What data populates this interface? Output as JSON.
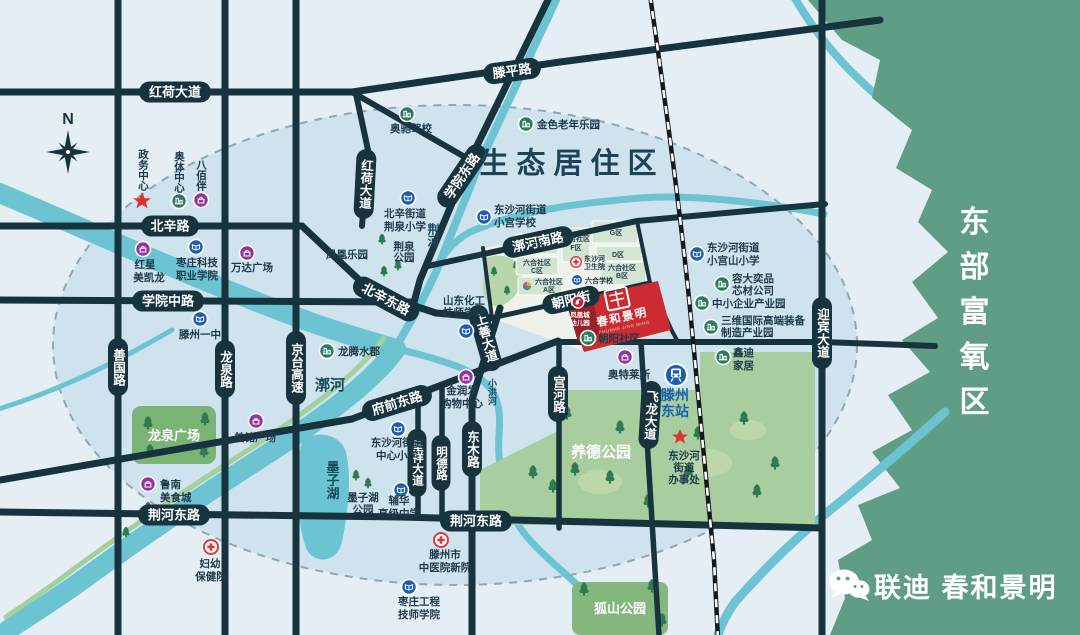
{
  "zones": {
    "eco": "生态居住区",
    "east": "东部富氧区"
  },
  "compass": {
    "north": "N"
  },
  "roads": {
    "honghe": "红荷大道",
    "tengping": "滕平路",
    "beixin": "北辛路",
    "xueyuan_mid": "学院中路",
    "xueyuan_east": "学院东路",
    "beixin_east": "北辛东路",
    "shanguo": "善国路",
    "longquan": "龙泉路",
    "jingtai": "京台高速",
    "guohe_south": "漷河南路",
    "chaoyang": "朝阳街",
    "shangshan": "上善大道",
    "fuqian_east": "府前东路",
    "gonghe": "宫河路",
    "dongmu": "东木路",
    "chengxiang": "呈祥大道",
    "mingde": "明德路",
    "jinghe_east": "荆河东路",
    "feilong": "飞龙大道",
    "yingbin": "迎宾大道"
  },
  "waters": {
    "jinghe": "荆河",
    "guohe": "漷河",
    "xiaohong": "小洪河",
    "mozihu": "墨子湖"
  },
  "parks": {
    "longquan_sq": "龙泉广场",
    "jingquan_1": "荆泉",
    "jingquan_2": "公园",
    "mozihu_1": "墨子湖",
    "mozihu_2": "公园",
    "yangde": "养德公园",
    "hushan": "狐山公园"
  },
  "blocks": {
    "prefix": "六合社区",
    "a": "A区",
    "b": "B区",
    "c": "C区",
    "d": "D区",
    "e": "E区",
    "f": "F区",
    "g": "G区"
  },
  "project": {
    "name": "春和景明",
    "pinyin": "CHUNHE JING MING"
  },
  "footer": {
    "brand": "联迪 春和景明"
  },
  "pois": {
    "zwzx": {
      "l1": "政务中心"
    },
    "atzx": {
      "l1": "奥体中心"
    },
    "bbb": {
      "l1": "八佰伴"
    },
    "hxmkl": {
      "l1": "红星",
      "l2": "美凯龙"
    },
    "zzkj": {
      "l1": "枣庄科技",
      "l2": "职业学院"
    },
    "wdgc": {
      "l1": "万达广场"
    },
    "tzyz": {
      "l1": "滕州一中"
    },
    "acjx": {
      "l1": "奥驰驾校"
    },
    "jslnly": {
      "l1": "金色老年乐园"
    },
    "bxjd": {
      "l1": "北辛街道",
      "l2": "荆泉小学"
    },
    "dshxg": {
      "l1": "东沙河街道",
      "l2": "小宫学校"
    },
    "sdhg": {
      "l1": "山东化工",
      "l2": "技师学院"
    },
    "ltsj": {
      "l1": "龙腾水郡"
    },
    "mmgc": {
      "l1": "美铭广场"
    },
    "lnmsc": {
      "l1": "鲁南",
      "l2": "美食城"
    },
    "fybjy": {
      "l1": "妇幼",
      "l2": "保健院"
    },
    "jrf": {
      "l1": "金润发",
      "l2": "购物中心"
    },
    "dshzx": {
      "l1": "东沙河街道",
      "l2": "中心小学"
    },
    "fhgz": {
      "l1": "辅华",
      "l2": "高级中学"
    },
    "tzszyy": {
      "l1": "滕州市",
      "l2": "中医院新院"
    },
    "zzgc": {
      "l1": "枣庄工程",
      "l2": "技师学院"
    },
    "dshwsy": {
      "l1": "东沙河",
      "l2": "卫生院"
    },
    "lhxx": {
      "l1": "六合学校"
    },
    "fhcyey": {
      "l1": "凤凰城",
      "l2": "幼儿园"
    },
    "cysq": {
      "l1": "朝阳社区"
    },
    "atls": {
      "l1": "奥特莱斯"
    },
    "xgsxx": {
      "l1": "东沙河街道",
      "l2": "小宫山小学"
    },
    "rdyp": {
      "l1": "容大奕品",
      "l2": "芯材公司"
    },
    "zxqy": {
      "l1": "中小企业产业园"
    },
    "swgj": {
      "l1": "三维国际高端装备",
      "l2": "制造产业园"
    },
    "xdjj": {
      "l1": "鑫迪",
      "l2": "家居"
    },
    "tzdz": {
      "l1": "滕州",
      "l2": "东站"
    },
    "dshbsc": {
      "l1": "东沙河",
      "l2": "街道",
      "l3": "办事处"
    },
    "fhly": {
      "l1": "凤凰乐园"
    }
  },
  "colors": {
    "road": "#17333e",
    "water": "#6cc3d2",
    "east_zone_green": "#5f9e85",
    "project_red": "#cc2b31",
    "icon_purple": "#93359c",
    "icon_blue": "#1d5fae",
    "icon_green": "#2b7b5e",
    "hospital_red": "#d8393c",
    "star_red": "#e03131"
  }
}
